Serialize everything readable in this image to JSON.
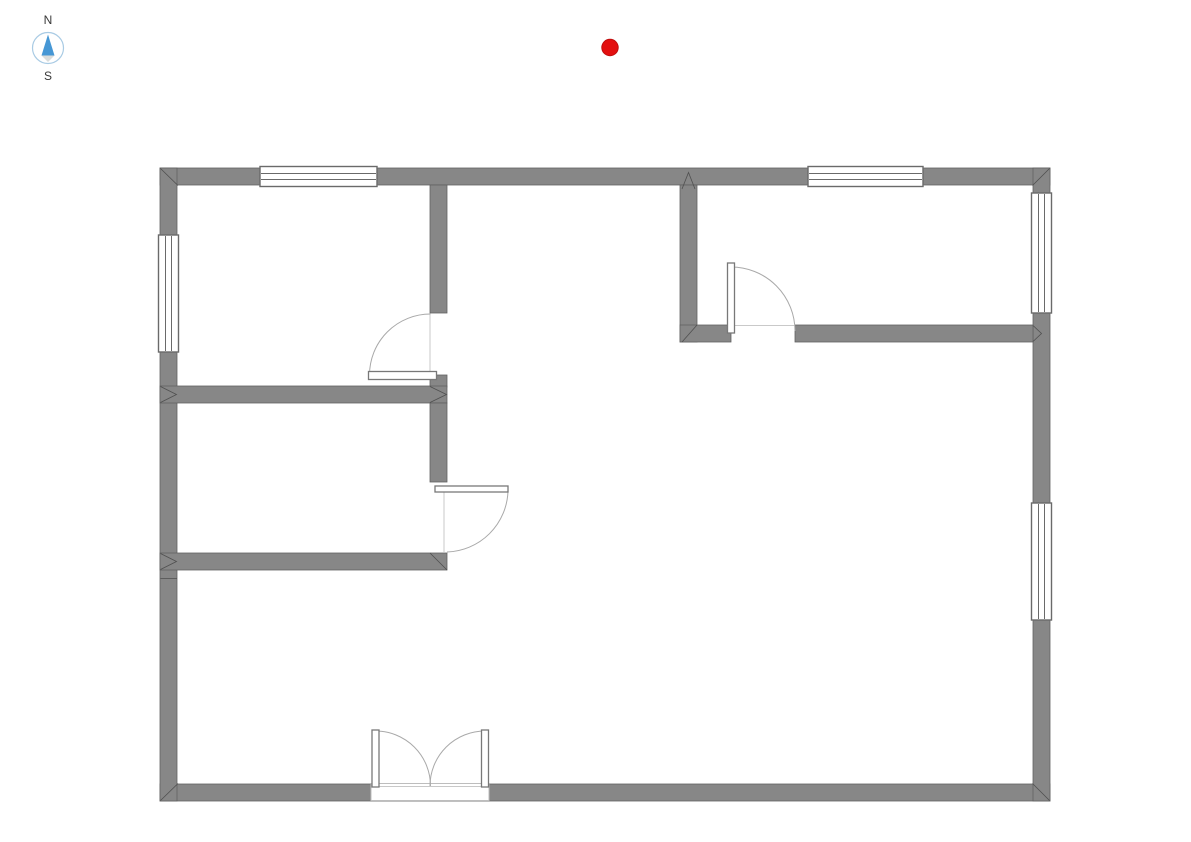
{
  "canvas": {
    "width": 1191,
    "height": 842,
    "background": "#ffffff"
  },
  "compass": {
    "north_label": "N",
    "south_label": "S",
    "ring_color": "#a9cbe4",
    "north_needle_color": "#4697d5",
    "south_needle_color": "#d9dcdb",
    "label_color": "#383838"
  },
  "marker": {
    "cx": 610,
    "cy": 47.5,
    "r": 8.2,
    "fill": "#e30f0f",
    "stroke": "#c00d0d"
  },
  "floorplan": {
    "colors": {
      "wall_fill": "#878787",
      "wall_edge": "#616161",
      "seam": "#4f4f4f",
      "window_frame": "#6a6a6a",
      "window_fill": "#ffffff",
      "door_leaf_fill": "#ffffff",
      "door_leaf_edge": "#787878",
      "door_arc": "#a9a9a9",
      "jamb": "#c9c9c9",
      "threshold_edge": "#bdbdbd",
      "threshold_line": "#c8c8c8"
    },
    "walls": [
      {
        "name": "outer-wall-top",
        "x": 160,
        "y": 168,
        "w": 890,
        "h": 17
      },
      {
        "name": "outer-wall-bottom",
        "x": 160,
        "y": 784,
        "w": 890,
        "h": 17
      },
      {
        "name": "outer-wall-left",
        "x": 160,
        "y": 168,
        "w": 17,
        "h": 633
      },
      {
        "name": "outer-wall-right",
        "x": 1033,
        "y": 168,
        "w": 17,
        "h": 633
      },
      {
        "name": "interior-wall-v1",
        "x": 430,
        "y": 185,
        "w": 17,
        "h": 128
      },
      {
        "name": "interior-wall-v1-stub",
        "x": 430,
        "y": 375,
        "w": 17,
        "h": 12
      },
      {
        "name": "interior-wall-h1",
        "x": 160,
        "y": 386,
        "w": 287,
        "h": 17
      },
      {
        "name": "interior-wall-v2",
        "x": 430,
        "y": 403,
        "w": 17,
        "h": 79
      },
      {
        "name": "interior-wall-h2",
        "x": 160,
        "y": 553,
        "w": 287,
        "h": 17
      },
      {
        "name": "interior-wall-v3",
        "x": 680,
        "y": 185,
        "w": 17,
        "h": 157
      },
      {
        "name": "interior-wall-h3-left",
        "x": 680,
        "y": 325,
        "w": 51,
        "h": 17
      },
      {
        "name": "interior-wall-h3-right",
        "x": 795,
        "y": 325,
        "w": 238,
        "h": 17
      }
    ],
    "windows": [
      {
        "name": "window-top-left",
        "orient": "h",
        "x": 260,
        "y": 166.5,
        "w": 117,
        "h": 20
      },
      {
        "name": "window-top-right",
        "orient": "h",
        "x": 808,
        "y": 166.5,
        "w": 115,
        "h": 20
      },
      {
        "name": "window-left",
        "orient": "v",
        "x": 158.5,
        "y": 235,
        "w": 20,
        "h": 117
      },
      {
        "name": "window-right-upper",
        "orient": "v",
        "x": 1031.5,
        "y": 193,
        "w": 20,
        "h": 120
      },
      {
        "name": "window-right-lower",
        "orient": "v",
        "x": 1031.5,
        "y": 503,
        "w": 20,
        "h": 117
      }
    ],
    "doors": [
      {
        "name": "door-northwest-room",
        "leaf": {
          "x": 368.5,
          "y": 371.5,
          "w": 68,
          "h": 8
        },
        "arc": "M430.5,314 A61,61 0 0 0 369.5,375"
      },
      {
        "name": "door-west-room",
        "leaf": {
          "x": 435,
          "y": 486,
          "w": 73,
          "h": 6
        },
        "arc": "M508,491 A63,63 0 0 1 447,552"
      },
      {
        "name": "door-northeast-room",
        "leaf": {
          "x": 727.5,
          "y": 263,
          "w": 7,
          "h": 70
        },
        "arc": "M731,267 A64,64 0 0 1 795,331"
      },
      {
        "name": "entry-double-door-left",
        "leaf": {
          "x": 372,
          "y": 730,
          "w": 7,
          "h": 57
        },
        "arc": "M375.5,731 A55,55 0 0 1 430.5,786"
      },
      {
        "name": "entry-double-door-right",
        "leaf": {
          "x": 481.5,
          "y": 730,
          "w": 7,
          "h": 57
        },
        "arc": "M485,731 A55,55 0 0 0 430,786"
      }
    ],
    "threshold": {
      "x": 371,
      "y": 783.5,
      "w": 118,
      "h": 17,
      "line_y": 786.5,
      "line_x1": 377,
      "line_x2": 483
    },
    "jambs": [
      "M430,314 L430,371",
      "M444,492 L444,552",
      "M735,325.5 L795,325.5"
    ],
    "seams": [
      "M160.5,168.5 L178,185.5",
      "M1049.5,168.5 L1032.5,185.5",
      "M160.5,800.5 L178,783.5",
      "M1049.5,800.5 L1032.5,783.5",
      "M682,189 L688.5,172.5 L695,189",
      "M160.5,386.5 L176.5,394.5 L160.5,402.5",
      "M430,386.5 L446.5,394.5 L430,402.5",
      "M160.5,553.5 L176.5,561.5 L160.5,569.5",
      "M430,553 L447,570",
      "M1033,325.5 L1041.5,333.5 L1033,341.5",
      "M682,342 L697,325",
      "M160.5,578.5 L177,578.5"
    ]
  }
}
